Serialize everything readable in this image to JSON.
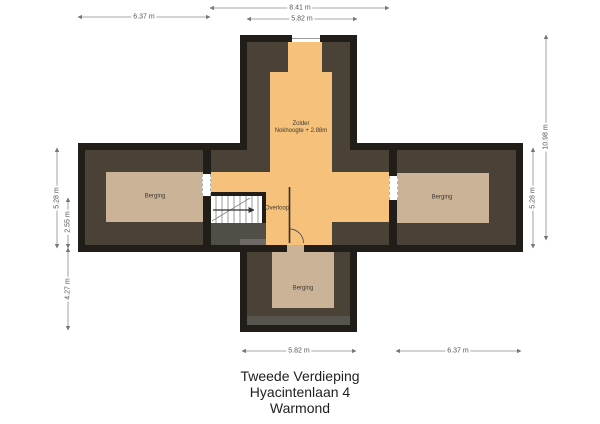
{
  "title": {
    "line1": "Tweede Verdieping",
    "line2": "Hyacintenlaan 4",
    "line3": "Warmond"
  },
  "rooms": {
    "zolder": {
      "name": "Zolder",
      "height_note": "Nokhoogte + 2.88m"
    },
    "berging_left": {
      "name": "Berging"
    },
    "berging_right": {
      "name": "Berging"
    },
    "berging_bottom": {
      "name": "Berging"
    },
    "overloop": {
      "name": "Overloop"
    }
  },
  "dimensions": {
    "top_total": "8.41 m",
    "top_wing": "5.82 m",
    "top_left_wing": "6.37 m",
    "left_band": "5.28 m",
    "left_stairwell": "2.55 m",
    "left_lower": "4.27 m",
    "right_total": "10.98 m",
    "right_band": "5.28 m",
    "bottom_wing": "5.82 m",
    "bottom_right_wing": "6.37 m"
  },
  "colors": {
    "wall": "#211e1a",
    "attic_floor": "#4a4236",
    "zolder_floor": "#f5c17b",
    "berging_floor": "#cab397",
    "understairs": "#514e48",
    "floor_strip": "#57534d",
    "dimension_line": "#777777",
    "background": "#ffffff"
  }
}
